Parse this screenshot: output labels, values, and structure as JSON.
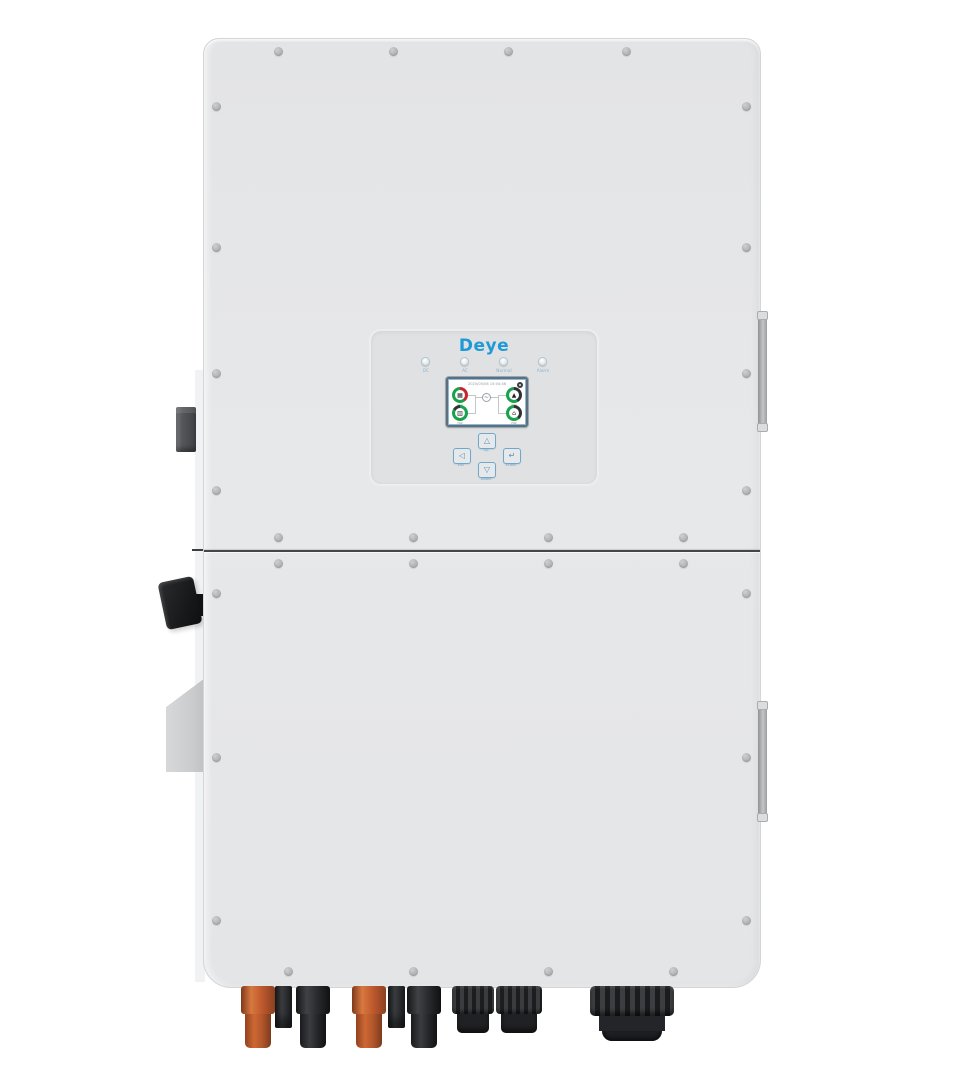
{
  "panel": {
    "logo": "Deye",
    "leds": [
      {
        "label": "DC"
      },
      {
        "label": "AC"
      },
      {
        "label": "Normal"
      },
      {
        "label": "Alarm"
      }
    ],
    "screen": {
      "datetime": "2020/05/06 15:04:46",
      "inverter_symbol": "~",
      "gauges": {
        "pv": {
          "icon": "▦",
          "value": "0W"
        },
        "battery": {
          "icon": "▥",
          "value": "0W"
        },
        "grid": {
          "icon": "▲",
          "value": "0W"
        },
        "load": {
          "icon": "⌂",
          "value": "0W"
        }
      }
    },
    "buttons": [
      {
        "id": "esc",
        "glyph": "◁",
        "label": "Esc"
      },
      {
        "id": "up",
        "glyph": "△",
        "label": "Up"
      },
      {
        "id": "down",
        "glyph": "▽",
        "label": "Down"
      },
      {
        "id": "enter",
        "glyph": "↵",
        "label": "Enter"
      }
    ]
  },
  "colors": {
    "brand_blue": "#1e9ad6",
    "body_gray": "#e5e6e8",
    "gauge_green": "#18a24b",
    "gauge_red": "#c8262d",
    "connector_orange": "#c05a2e",
    "connector_black": "#26272a"
  }
}
